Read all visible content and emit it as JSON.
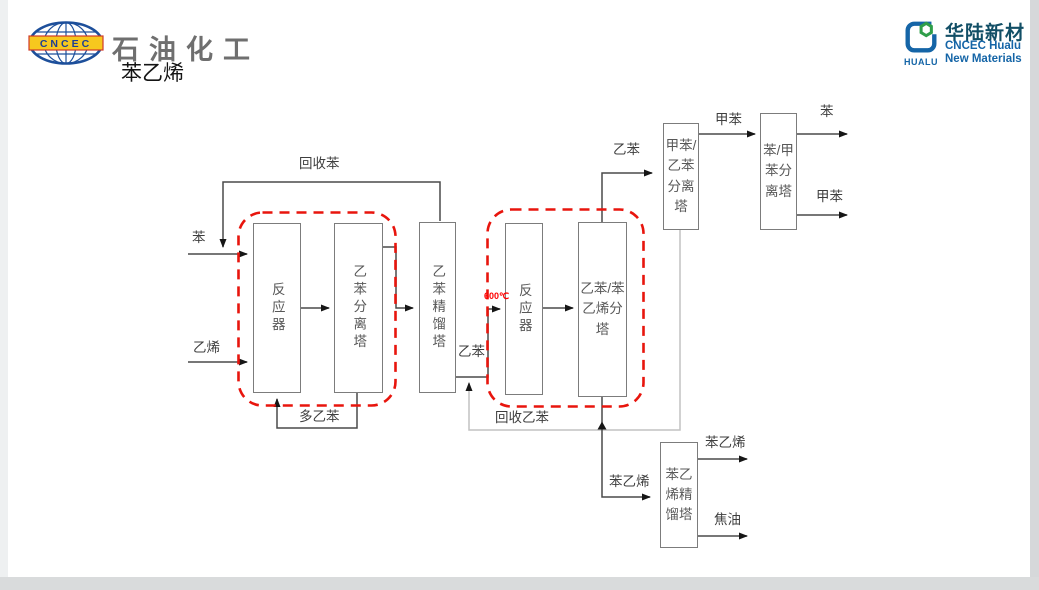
{
  "header": {
    "cncec_logo": {
      "band_text": "CNCEC"
    },
    "brand_script": "石油化工",
    "page_title": "苯乙烯",
    "hualu_logo": {
      "cn_name": "华陆新材",
      "en_line1": "CNCEC Hualu",
      "en_line2": "New Materials",
      "icon_caption": "HUALU"
    }
  },
  "diagram": {
    "equipment": {
      "reactor1": {
        "label": "反应器"
      },
      "eb_separation_tower": {
        "label": "乙苯分离塔"
      },
      "eb_distillation_tower": {
        "label": "乙苯精馏塔"
      },
      "reactor2": {
        "label": "反应器"
      },
      "eb_sm_splitter": {
        "label": "乙苯/苯\n乙烯分\n塔"
      },
      "toluene_eb_tower": {
        "label": "甲苯/\n乙苯\n分离\n塔"
      },
      "benzene_toluene_tower": {
        "label": "苯/甲\n苯分\n离塔"
      },
      "sm_distillation_tower": {
        "label": "苯乙\n烯精\n馏塔"
      }
    },
    "labels": {
      "recycle_benzene": "回收苯",
      "benzene_feed": "苯",
      "ethylene_feed": "乙烯",
      "poly_eb": "多乙苯",
      "eb_junction": "乙苯",
      "reactor2_inlet_temp": "600℃",
      "recycle_eb": "回收乙苯",
      "eb_overhead": "乙苯",
      "toluene_mid": "甲苯",
      "benzene_product": "苯",
      "toluene_product": "甲苯",
      "styrene_feed": "苯乙烯",
      "styrene_product": "苯乙烯",
      "tar_product": "焦油"
    },
    "highlight_color": "#e8150d",
    "line_color": "#4a4a4a",
    "recycle_line_color": "#c2c2c2"
  }
}
